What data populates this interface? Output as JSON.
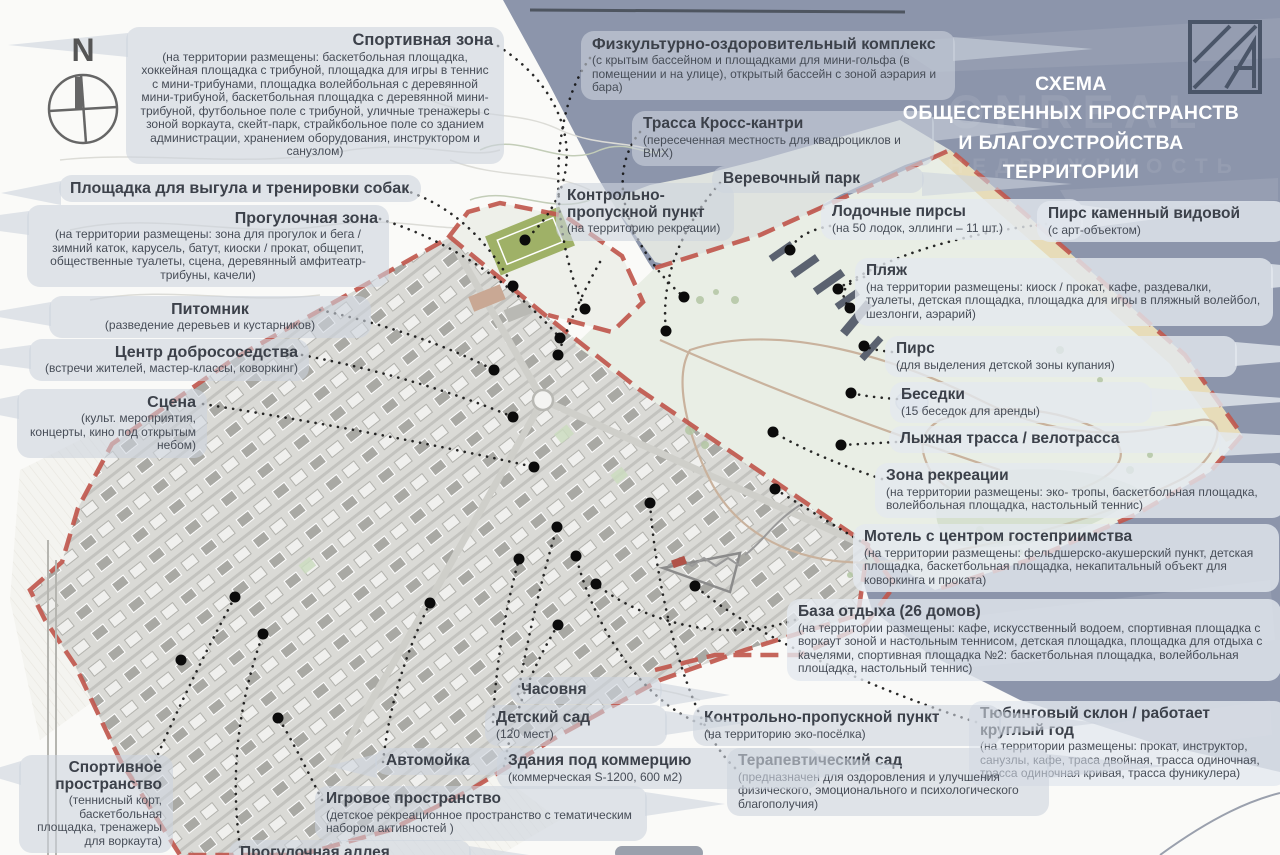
{
  "header": {
    "title_lines": [
      "СХЕМА",
      "ОБЩЕСТВЕННЫХ ПРОСТРАНСТВ",
      "И БЛАГОУСТРОЙСТВА",
      "ТЕРРИТОРИИ"
    ],
    "watermark_line1": "ONREAL",
    "watermark_line2": "НЕДВИЖИМОСТЬ"
  },
  "compass": {
    "north_letter": "N"
  },
  "labels": [
    {
      "id": "sport-zone",
      "title": "Спортивная зона",
      "desc": "(на территории размещены: баскетбольная площадка, хоккейная площадка с трибуной, площадка для игры в теннис с мини-трибунами, площадка волейбольная с деревянной мини-трибуной, баскетбольная площадка с деревянной мини-трибуной, футбольное поле с трибуной, уличные тренажеры с зоной воркаута, скейт-парк, страйкбольное поле со зданием администрации, хранением оборудования, инструктором и санузлом)"
    },
    {
      "id": "dog-area",
      "title": "Площадка для выгула и тренировки собак",
      "desc": ""
    },
    {
      "id": "walking-zone",
      "title": "Прогулочная зона",
      "desc": "(на территории размещены: зона для прогулок и бега / зимний каток, карусель, батут, киоски / прокат, общепит, общественные туалеты, сцена, деревянный амфитеатр-трибуны, качели)"
    },
    {
      "id": "nursery",
      "title": "Питомник",
      "desc": "(разведение деревьев и кустарников)"
    },
    {
      "id": "neighbor-center",
      "title": "Центр добрососедства",
      "desc": "(встречи жителей, мастер-классы, коворкинг)"
    },
    {
      "id": "stage",
      "title": "Сцена",
      "desc": "(культ. мероприятия, концерты, кино под открытым небом)"
    },
    {
      "id": "fok",
      "title": "Физкультурно-оздоровительный комплекс",
      "desc": "(с крытым бассейном и площадками для мини-гольфа (в помещении и на улице), открытый бассейн с зоной аэрария и бара)"
    },
    {
      "id": "cross-country",
      "title": "Трасса Кросс-кантри",
      "desc": "(пересеченная местность для квадроциклов и BMX)"
    },
    {
      "id": "rope-park",
      "title": "Веревочный парк",
      "desc": ""
    },
    {
      "id": "kpp-recreation",
      "title": "Контрольно-пропускной пункт",
      "desc": "(на территорию рекреации)"
    },
    {
      "id": "boat-piers",
      "title": "Лодочные пирсы",
      "desc": "(на 50 лодок, эллинги – 11 шт.)"
    },
    {
      "id": "stone-pier",
      "title": "Пирс каменный видовой",
      "desc": "(с арт-объектом)"
    },
    {
      "id": "beach",
      "title": "Пляж",
      "desc": "(на территории размещены: киоск / прокат, кафе, раздевалки, туалеты, детская площадка, площадка для игры в пляжный волейбол, шезлонги, аэрарий)"
    },
    {
      "id": "pier",
      "title": "Пирс",
      "desc": "(для выделения детской зоны купания)"
    },
    {
      "id": "gazebos",
      "title": "Беседки",
      "desc": "(15 беседок для аренды)"
    },
    {
      "id": "ski-track",
      "title": "Лыжная трасса / велотрасса",
      "desc": ""
    },
    {
      "id": "recreation-zone",
      "title": "Зона рекреации",
      "desc": "(на территории размещены: эко- тропы, баскетбольная площадка, волейбольная площадка, настольный теннис)"
    },
    {
      "id": "motel",
      "title": "Мотель с центром гостеприимства",
      "desc": "(на территории размещены: фельдшерско-акушерский пункт, детская площадка, баскетбольная площадка, некапитальный объект для коворкинга и проката)"
    },
    {
      "id": "rest-base",
      "title": "База отдыха (26 домов)",
      "desc": "(на территории размещены: кафе, искусственный водоем, спортивная площадка с воркаут зоной и настольным теннисом, детская площадка, площадка для отдыха с качелями, спортивная площадка №2: баскетбольная площадка, волейбольная площадка, настольный теннис)"
    },
    {
      "id": "tubing",
      "title": "Тюбинговый склон / работает круглый год",
      "desc": "(на территории размещены: прокат, инструктор, санузлы, кафе, траса двойная, трасса одиночная, трасса одиночная кривая, трасса фуникулера)"
    },
    {
      "id": "kpp-eco",
      "title": "Контрольно-пропускной пункт",
      "desc": "(на территорию эко-посёлка)"
    },
    {
      "id": "therapy-garden",
      "title": "Терапевтический сад",
      "desc": "(предназначен для оздоровления и улучшения физического, эмоционального и психологического благополучия)"
    },
    {
      "id": "chapel",
      "title": "Часовня",
      "desc": ""
    },
    {
      "id": "kindergarten",
      "title": "Детский сад",
      "desc": "(120 мест)"
    },
    {
      "id": "carwash",
      "title": "Автомойка",
      "desc": ""
    },
    {
      "id": "commerce",
      "title": "Здания под коммерцию",
      "desc": "(коммерческая S-1200, 600 м2)"
    },
    {
      "id": "play-space",
      "title": "Игровое пространство",
      "desc": "(детское рекреационное пространство с тематическим набором активностей )"
    },
    {
      "id": "sport-space",
      "title": "Спортивное пространство",
      "desc": "(теннисный корт, баскетбольная площадка, тренажеры для воркаута)"
    },
    {
      "id": "alley",
      "title": "Прогулочная аллея",
      "desc": ""
    }
  ],
  "map_colors": {
    "water": "#8c95ab",
    "boundary_red": "#c0584e",
    "housing": "#dadad6",
    "park": "#e9eee5",
    "sports_field": "#9fb167",
    "beach_sand": "#e7dcb9",
    "dots": "#0b0b0b"
  }
}
